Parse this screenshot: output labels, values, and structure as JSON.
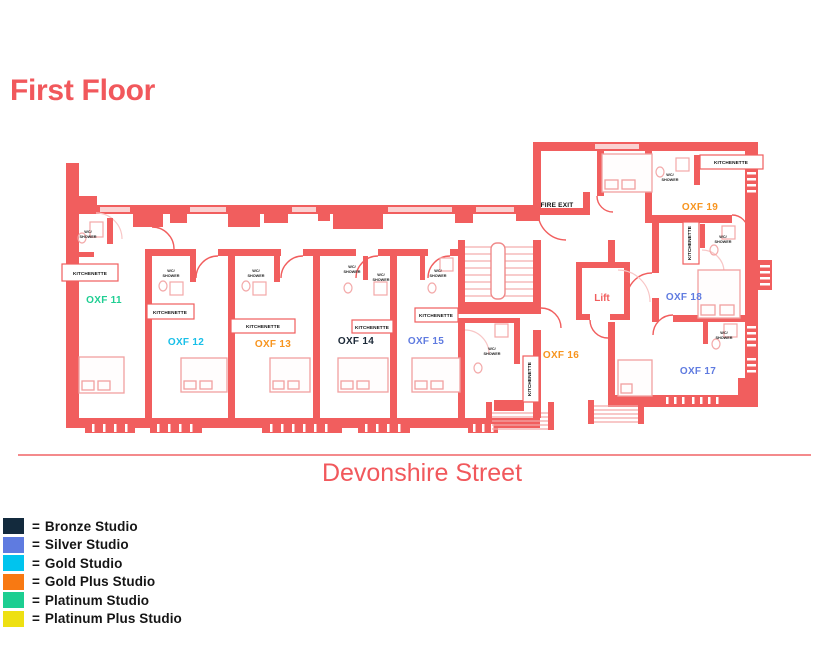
{
  "title": "First Floor",
  "street_label": "Devonshire Street",
  "plan": {
    "labels": {
      "fire_exit": "FIRE EXIT",
      "lift": "Lift",
      "kitchenette": "KITCHENETTE",
      "wc1": "WC/",
      "wc2": "SHOWER"
    },
    "rooms": [
      {
        "id": "OXF 11",
        "category": "Platinum Studio",
        "color": "#1FCE92"
      },
      {
        "id": "OXF 12",
        "category": "Gold Studio",
        "color": "#18BFE8"
      },
      {
        "id": "OXF 13",
        "category": "Gold Plus Studio",
        "color": "#F7941E"
      },
      {
        "id": "OXF 14",
        "category": "Bronze Studio",
        "color": "#1B2837"
      },
      {
        "id": "OXF 15",
        "category": "Silver Studio",
        "color": "#5F7BE0"
      },
      {
        "id": "OXF 16",
        "category": "Gold Plus Studio",
        "color": "#F7941E"
      },
      {
        "id": "OXF 17",
        "category": "Silver Studio",
        "color": "#5F7BE0"
      },
      {
        "id": "OXF 18",
        "category": "Silver Studio",
        "color": "#5F7BE0"
      },
      {
        "id": "OXF 19",
        "category": "Gold Plus Studio",
        "color": "#F7941E"
      }
    ]
  },
  "legend": {
    "eq": "=",
    "items": [
      {
        "label": "Bronze Studio",
        "color": "#132A3D"
      },
      {
        "label": "Silver Studio",
        "color": "#5F7BE0"
      },
      {
        "label": "Gold Studio",
        "color": "#00C4EE"
      },
      {
        "label": "Gold Plus Studio",
        "color": "#F87912"
      },
      {
        "label": "Platinum Studio",
        "color": "#1CCE91"
      },
      {
        "label": "Platinum Plus Studio",
        "color": "#EEE012"
      }
    ]
  },
  "colors": {
    "wall": "#F15E5E",
    "accent": "#F1585C"
  }
}
